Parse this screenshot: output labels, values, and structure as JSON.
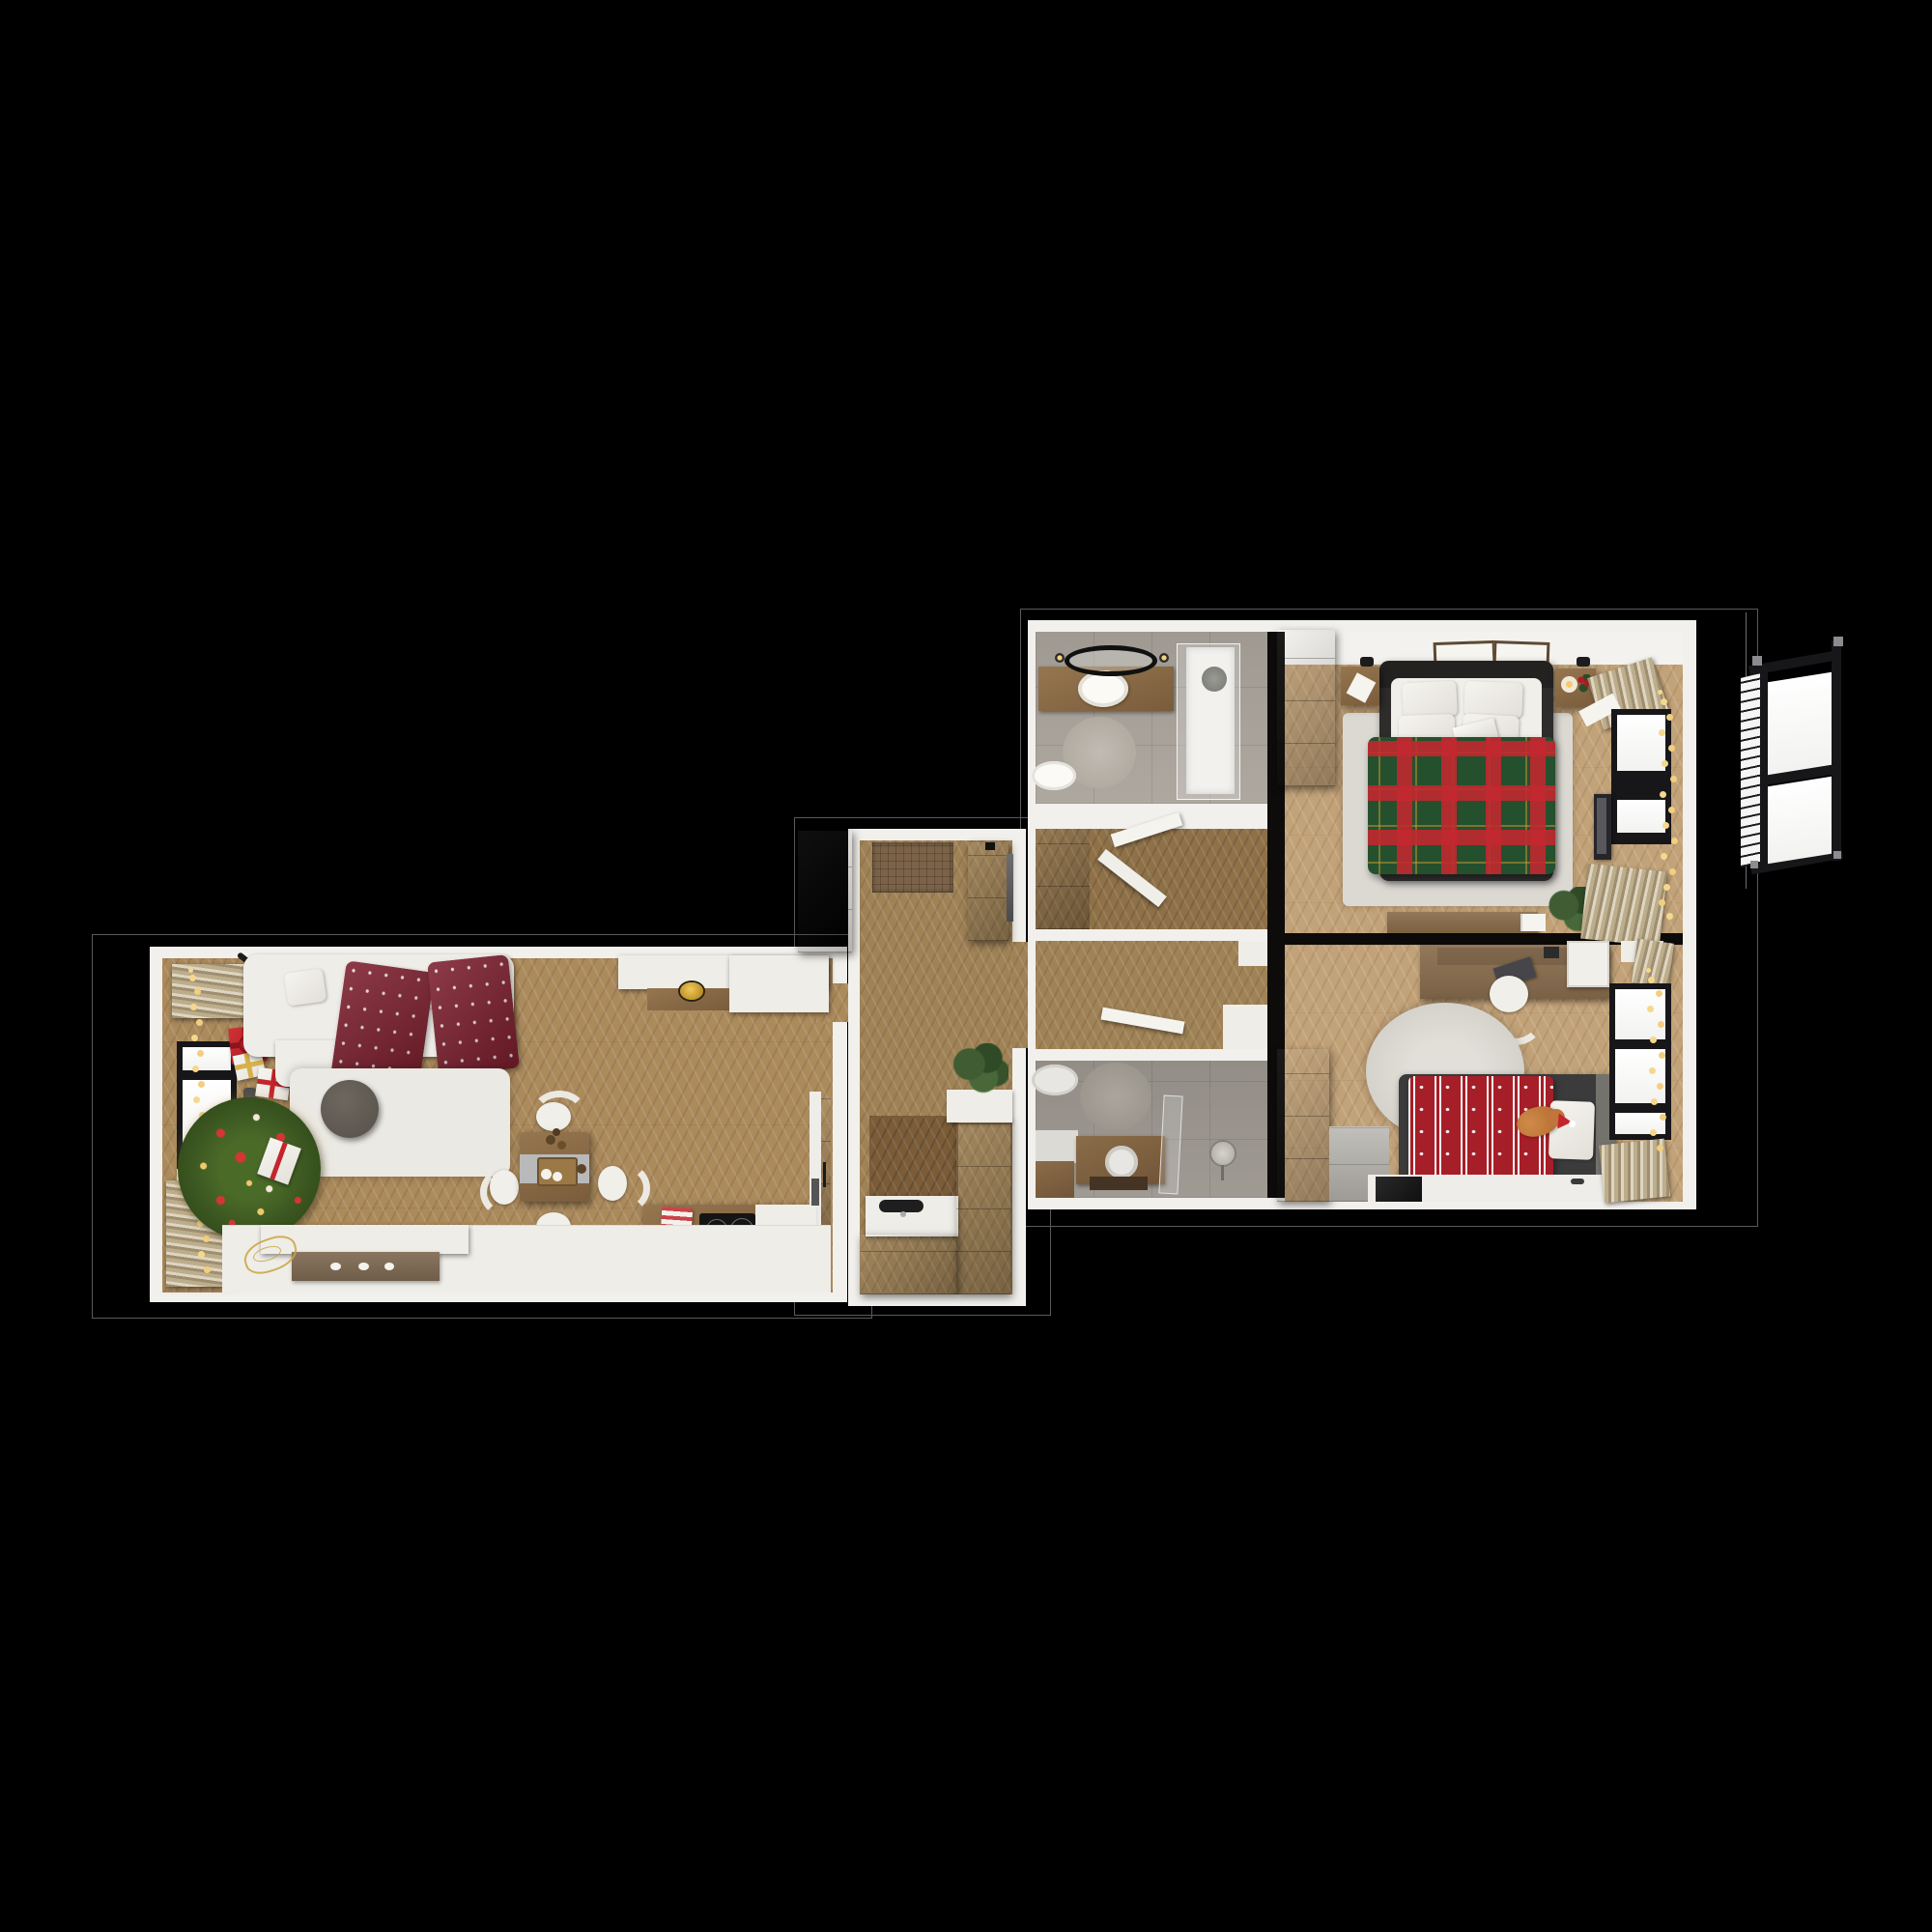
{
  "scene": {
    "description": "Photorealistic top-down 3D render of a two-bedroom apartment floor plan decorated for Christmas, shown on a black background with a detached 3D exterior window at the right",
    "style": "3D floor plan, top view",
    "decor_theme": "Christmas",
    "background": "#000000"
  },
  "palette": {
    "bg": "#000000",
    "outline": "#5a5a5a",
    "wall": "#f2f0ec",
    "floor_living": "#ab8a5c",
    "floor_hall": "#9f8256",
    "floor_bedroom": "#c2a278",
    "floor_dark": "#7a5c38",
    "floor_closet": "#8f7148",
    "tile": "#a9a39b",
    "tile_rug": "#c1bcb3",
    "cabinet_dark": "#3a2a1b",
    "wood_mid": "#8a6a48",
    "wood_tv": "#7c6a55",
    "furniture_white": "#efede8",
    "rug_white": "#ebe9e3",
    "rug_round": "#dcd9d3",
    "throw_burgundy": "#7d1f2e",
    "plaid_green": "#25502e",
    "plaid_red": "#c3272f",
    "plaid_gold": "#d8a531",
    "duvet_red": "#a61e28",
    "tree_green": "#3a5520",
    "ornament_red": "#d43535",
    "ornament_white": "#f3e9d8",
    "lights_warm": "#f6d88d",
    "curtain_beige": "#c9bb9b",
    "frame_black": "#17171a",
    "glass_white": "#fcfcfb",
    "mat_brown": "#7b6248",
    "metal_gray": "#8a8a86",
    "gold_accent": "#d2a023",
    "cat_orange": "#c0763a",
    "runner_gray": "#b9b9b9",
    "stone_gray": "#b3b0aa"
  },
  "rooms": [
    {
      "id": "living-room",
      "name": "Living room with open kitchen",
      "items": [
        "white corner sofa with burgundy snowflake throws",
        "white shaggy rug",
        "round dark coffee table",
        "Christmas tree with red, white and gold ornaments",
        "stack of gift boxes",
        "radiator",
        "window with beige curtains and string lights",
        "dining table with gray runner, pinecone tray and four white chairs",
        "white sideboard with wood inset and golden bowl",
        "kitchen counter with black induction cooktop and red towel",
        "white TV console with wood front and three knobs",
        "golden deer figurine"
      ]
    },
    {
      "id": "entry-hall",
      "name": "Entry hall with kitchenette",
      "items": [
        "dark brown wardrobe",
        "brown doormat",
        "dark dresser with wall mirror",
        "dark kitchenette corner cabinets",
        "white counter with black sink",
        "potted plant on white shelf"
      ]
    },
    {
      "id": "bathroom-1",
      "name": "Bathroom 1",
      "items": [
        "wood vanity with white oval sink",
        "round black-framed mirror with two sconces",
        "glass walk-in shower with rain head",
        "white toilet",
        "round stone rug"
      ]
    },
    {
      "id": "closet-hall",
      "name": "Inner hall with closet",
      "items": [
        "dark brown wardrobe",
        "two open white doors"
      ]
    },
    {
      "id": "corridor",
      "name": "Corridor",
      "items": [
        "chevron parquet",
        "open white door",
        "white threshold steps"
      ]
    },
    {
      "id": "bathroom-2",
      "name": "Bathroom 2",
      "items": [
        "white toilet",
        "round stone rug",
        "wood vanity with round vessel sink",
        "glass shower screen",
        "standing round mirror",
        "white bench",
        "wood cabinet"
      ]
    },
    {
      "id": "bedroom-main",
      "name": "Main bedroom",
      "items": [
        "double bed with dark frame and green tartan duvet",
        "four white pillows and laptop",
        "two wood nightstands",
        "candle and holly sprig",
        "two picture frames above headboard",
        "dark brown wardrobe",
        "light area rug",
        "low wood media bench with books",
        "potted plant",
        "black-framed window with fairy lights",
        "wall-mounted TV",
        "beige curtains"
      ]
    },
    {
      "id": "bedroom-kids",
      "name": "Kids bedroom",
      "items": [
        "wood desk with laptop and white shelving",
        "round white desk chair",
        "large round light rug",
        "single bed with red Nordic snowflake duvet",
        "white pillow",
        "ginger cat wearing a Santa hat",
        "dark brown wardrobe",
        "stone block side table",
        "black-framed window with fairy lights",
        "beige curtains"
      ]
    }
  ],
  "exterior": {
    "window": "Open black casement window with two white panes and horizontal blinds, rendered in 3D perspective outside the bedroom wall"
  }
}
